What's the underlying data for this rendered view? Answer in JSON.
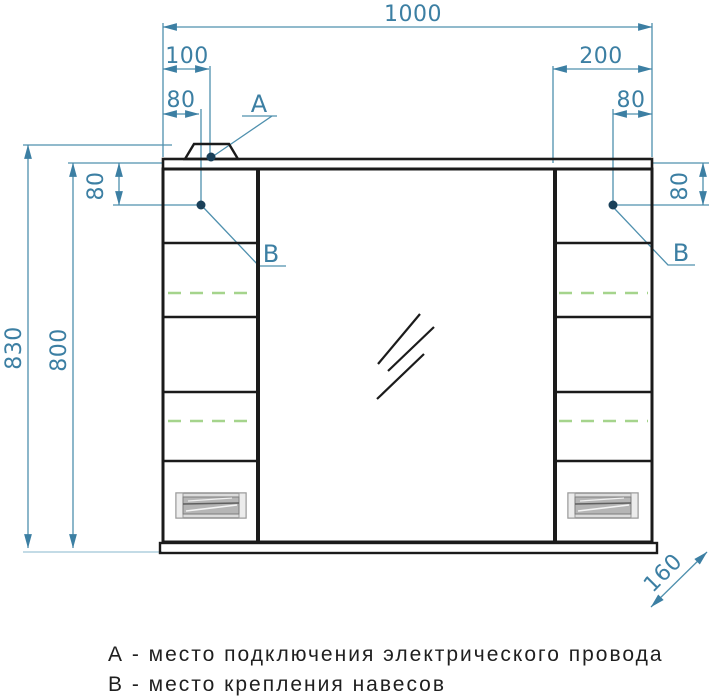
{
  "drawing": {
    "type": "furniture technical drawing - mirror cabinet front view",
    "colors": {
      "outline": "#1b1b1b",
      "dimension_text": "#3c7fa3",
      "dimension_line": "#4f90ae",
      "anchor_dot": "#1a4059",
      "adjustable_shelf_dashed": "#a5d48c",
      "handle_fill": "#c9c9c9"
    },
    "dimensions": {
      "total_width": "1000",
      "top_left_offset": "100",
      "top_left_hole": "80",
      "top_right_offset": "200",
      "top_right_hole": "80",
      "total_height": "830",
      "body_height": "800",
      "side_hole_left": "80",
      "side_hole_right": "80",
      "depth": "160"
    },
    "callouts": {
      "a": "А",
      "b_left": "В",
      "b_right": "В"
    },
    "legend": {
      "line_a": "А - место подключения электрического провода",
      "line_b": "В - место крепления навесов"
    }
  }
}
